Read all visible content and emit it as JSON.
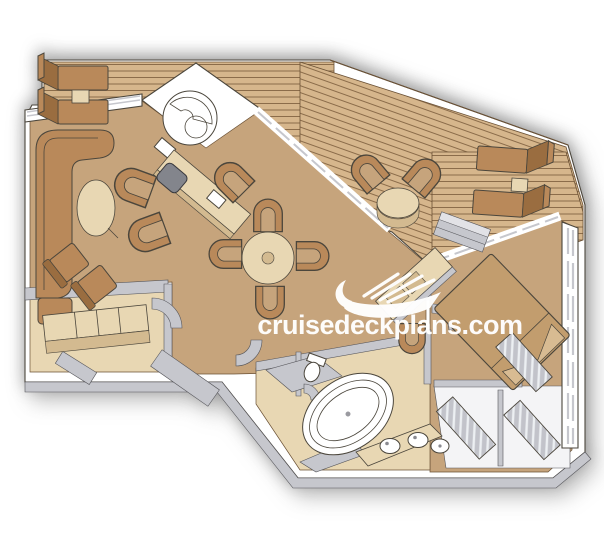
{
  "watermark": {
    "text": "cruisedeckplans.com",
    "logo": "cruise-ship-icon"
  },
  "colors": {
    "background": "#ffffff",
    "deck": "#d6b68c",
    "deck_line": "#7e5f3e",
    "floor": "#c6a47c",
    "cream": "#e8d7b3",
    "cream_dark": "#d3ba90",
    "furniture": "#b9895a",
    "furniture_dark": "#9a6d40",
    "bed": "#c29d6e",
    "wall_white": "#ffffff",
    "wall_gray": "#c6c7cd",
    "outline": "#4b463c",
    "watermark": "#ffffff"
  }
}
